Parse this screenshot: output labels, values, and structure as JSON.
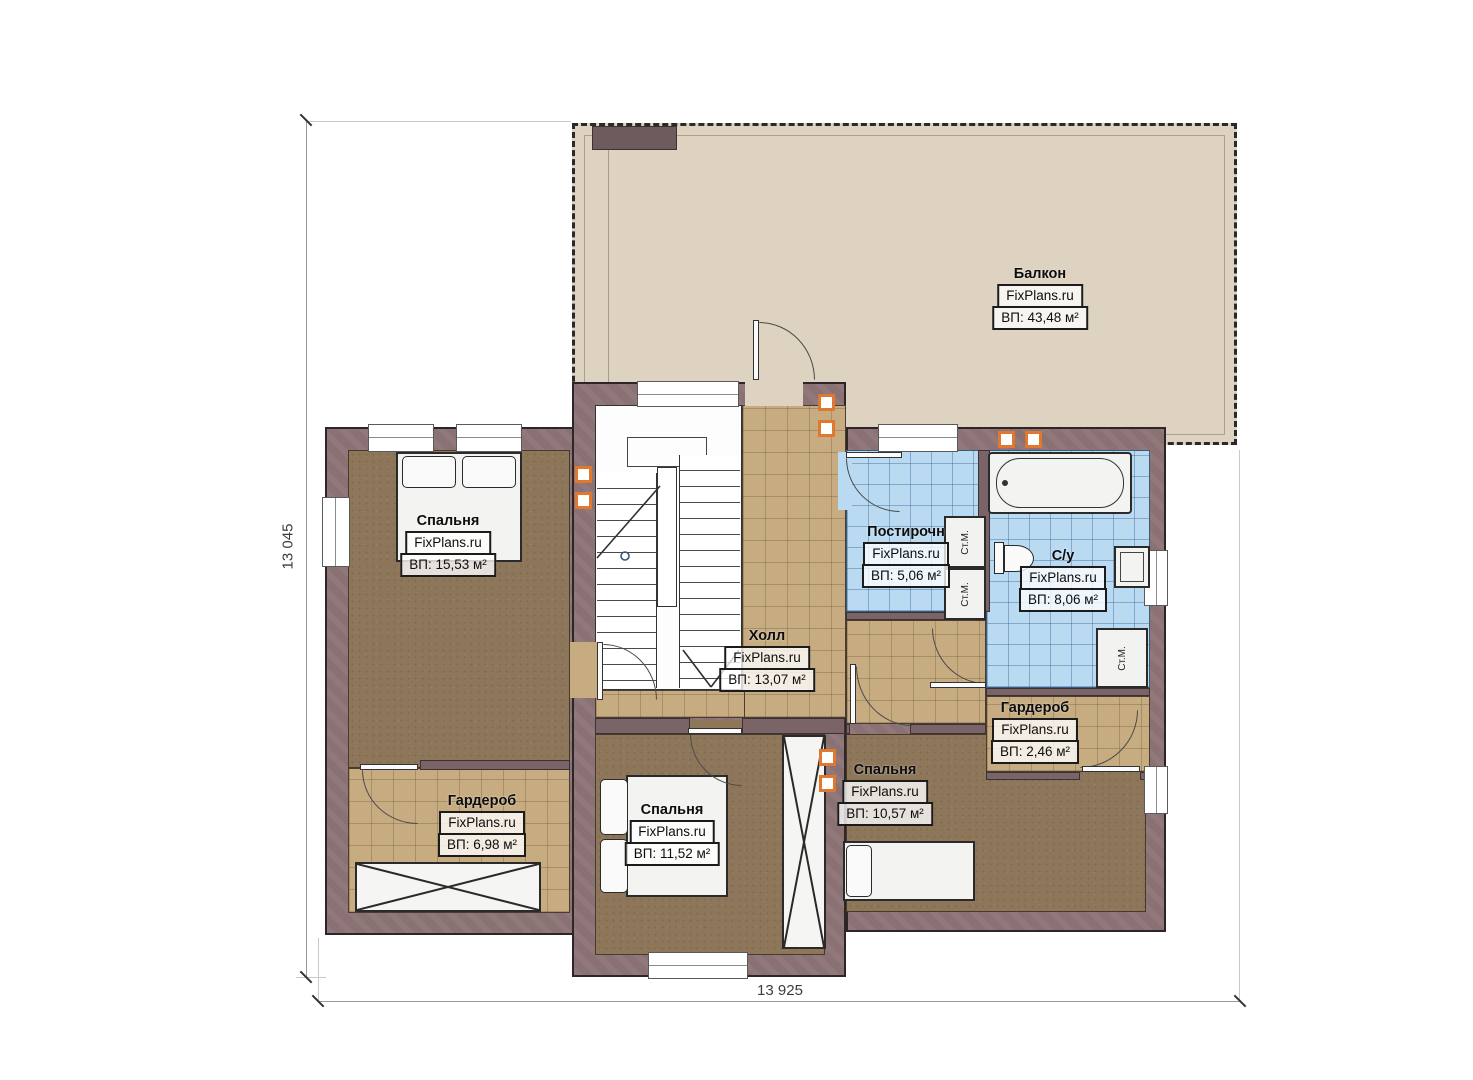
{
  "plan": {
    "rooms": [
      {
        "id": "balcony",
        "name": "Балкон",
        "brand": "FixPlans.ru",
        "area": "ВП: 43,48 м²"
      },
      {
        "id": "bedroom-left",
        "name": "Спальня",
        "brand": "FixPlans.ru",
        "area": "ВП: 15,53 м²"
      },
      {
        "id": "laundry",
        "name": "Постирочн",
        "brand": "FixPlans.ru",
        "area": "ВП: 5,06 м²"
      },
      {
        "id": "bathroom",
        "name": "С/у",
        "brand": "FixPlans.ru",
        "area": "ВП: 8,06 м²"
      },
      {
        "id": "hall",
        "name": "Холл",
        "brand": "FixPlans.ru",
        "area": "ВП: 13,07 м²"
      },
      {
        "id": "wardrobe-small",
        "name": "Гардероб",
        "brand": "FixPlans.ru",
        "area": "ВП: 2,46 м²"
      },
      {
        "id": "bedroom-right",
        "name": "Спальня",
        "brand": "FixPlans.ru",
        "area": "ВП: 10,57 м²"
      },
      {
        "id": "bedroom-center",
        "name": "Спальня",
        "brand": "FixPlans.ru",
        "area": "ВП: 11,52 м²"
      },
      {
        "id": "wardrobe-left",
        "name": "Гардероб",
        "brand": "FixPlans.ru",
        "area": "ВП: 6,98 м²"
      }
    ],
    "appliances": {
      "washing_machine": "Ст.М."
    },
    "dimensions": {
      "vertical_total": "13 045",
      "horizontal_total": "13 925"
    },
    "colors": {
      "wall": "#8a7174",
      "wall_outline": "#2d2527",
      "balcony_floor": "#ded3c1",
      "tile_tan": "#c7ac81",
      "tile_blue": "#badaf2",
      "floor_brown": "#8d7659",
      "vent_orange": "#e1782f"
    }
  }
}
